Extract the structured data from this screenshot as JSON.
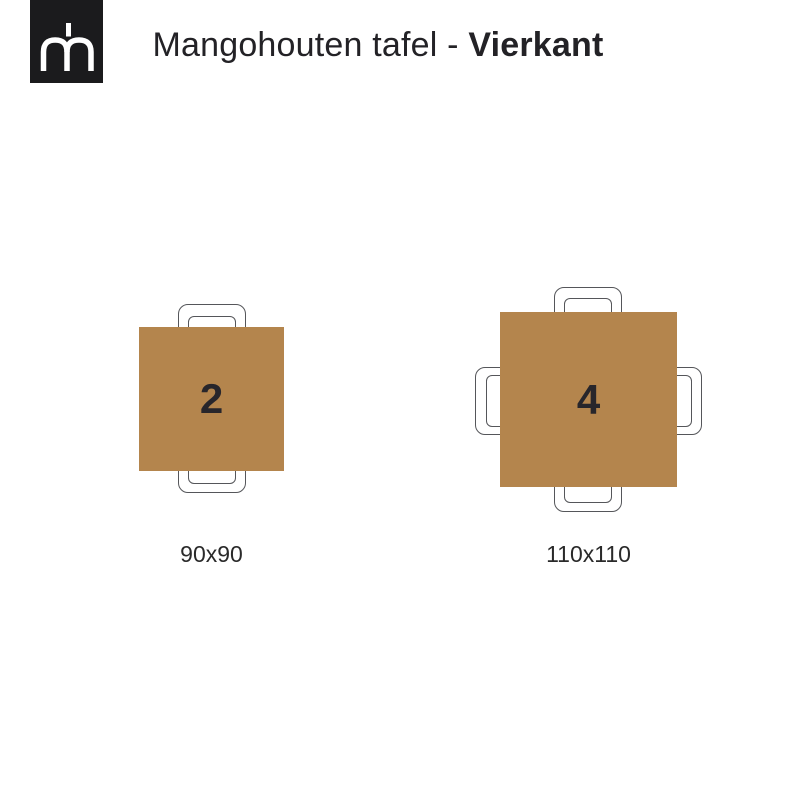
{
  "header": {
    "logo_monogram": "mh",
    "title_regular": "Mangohouten tafel - ",
    "title_bold": "Vierkant"
  },
  "tables": [
    {
      "seats": "2",
      "size": "90x90",
      "chair_positions": [
        "top",
        "bottom"
      ]
    },
    {
      "seats": "4",
      "size": "110x110",
      "chair_positions": [
        "top",
        "bottom",
        "left",
        "right"
      ]
    }
  ],
  "colors": {
    "table_top": "#B4854D",
    "logo_background": "#1B1B1D",
    "logo_monogram": "#FFFFFF",
    "chair_outline": "#55565A",
    "text": "#232226"
  }
}
